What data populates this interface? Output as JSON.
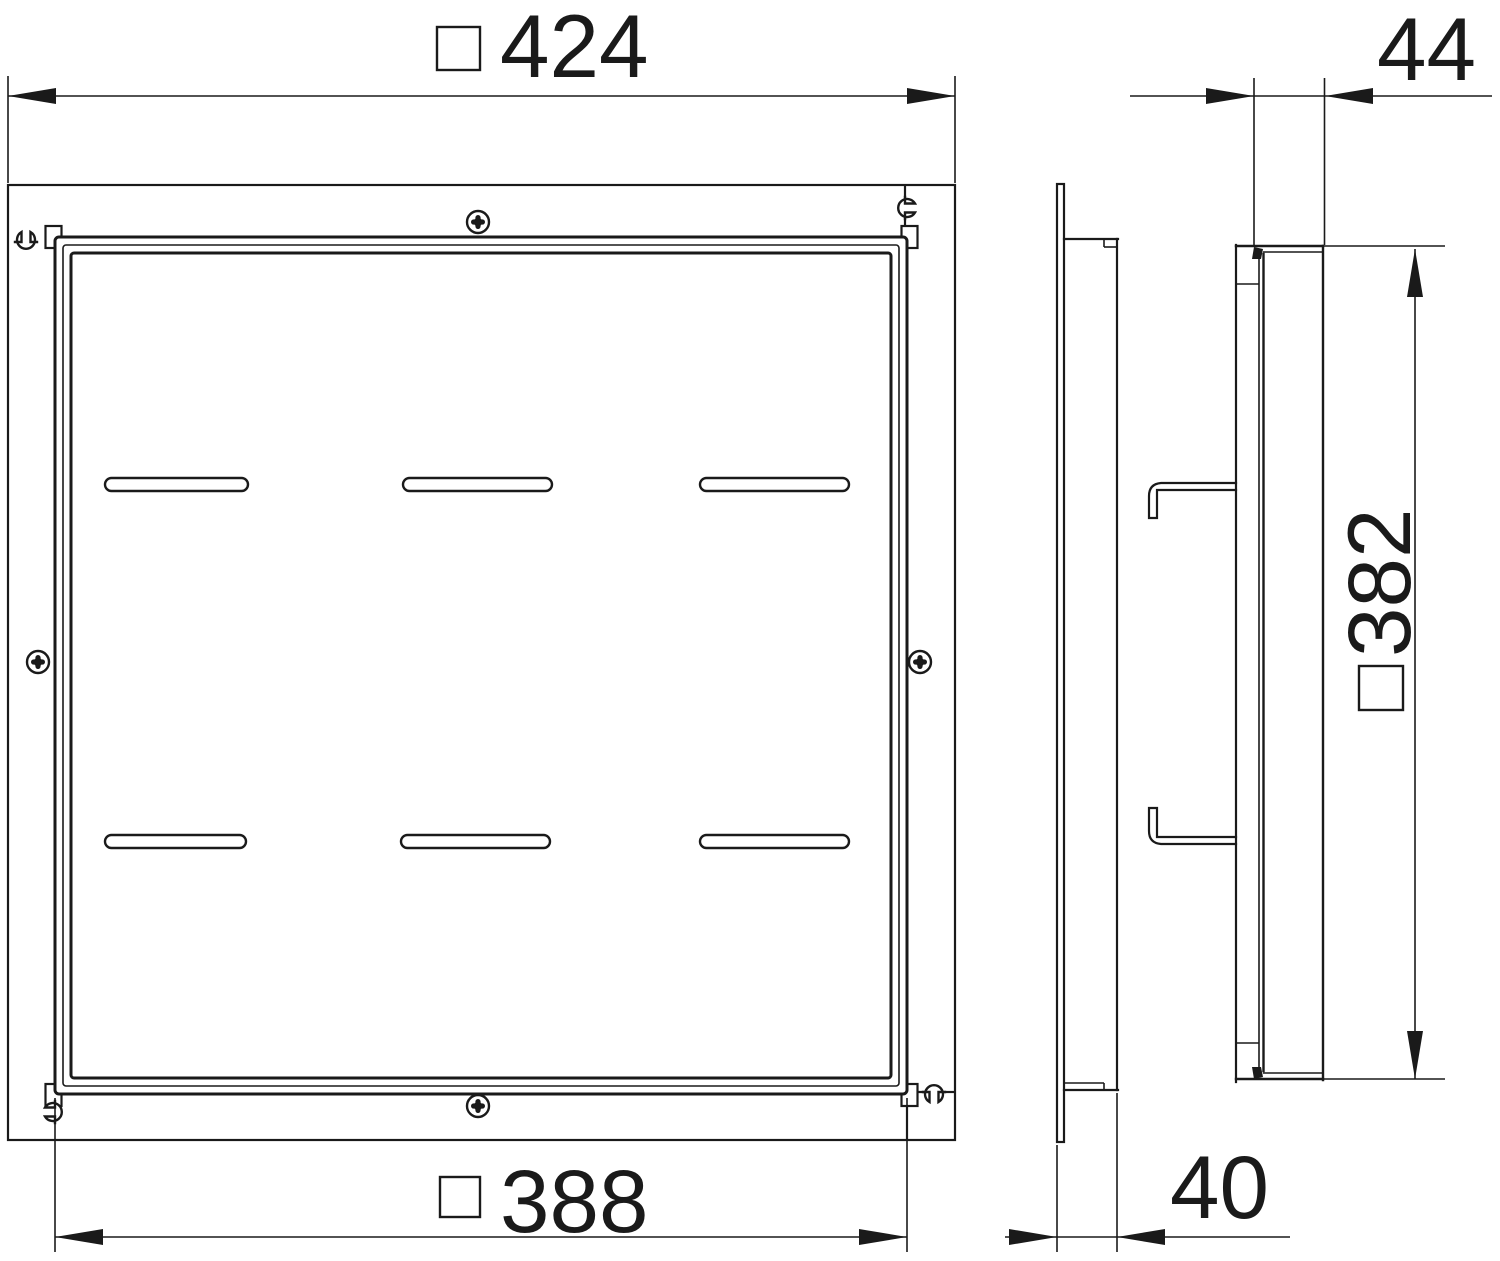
{
  "drawing": {
    "type": "technical-dimension-drawing",
    "views": {
      "front": "front view of frame with cover",
      "side": "side profile view"
    },
    "line_color": "#1a1a1a",
    "background": "#ffffff"
  },
  "dimensions": {
    "outer_width": {
      "symbol": "□",
      "value": "424"
    },
    "cover_width": {
      "symbol": "□",
      "value": "388"
    },
    "cover_height": {
      "symbol": "□",
      "value": "382"
    },
    "cover_depth": {
      "value": "44"
    },
    "frame_depth": {
      "value": "40"
    }
  }
}
